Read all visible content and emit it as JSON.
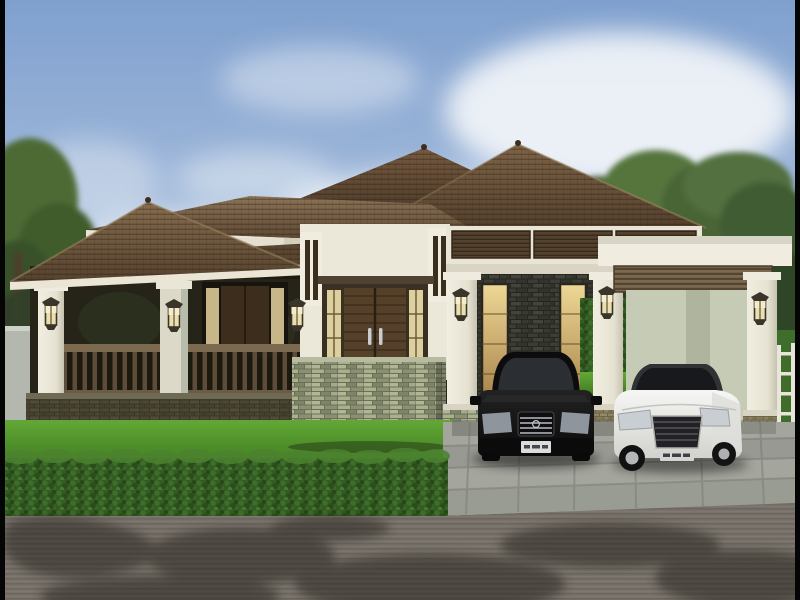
{
  "scene": {
    "type": "architectural-render",
    "description": "3D rendering of a single-story tropical bungalow: hip tile roofs, covered porch with wood railing, stacked-stone accent wall with double wood doors, lantern sconces, twin carports sheltering a black sedan and a white coupe, green hedge, paver driveway and shadowed asphalt road under a cloudy blue sky",
    "sky": {
      "top": "#7fa0ce",
      "bottom": "#bccfe6",
      "cloud": "#f2f5f9"
    },
    "vegetation": {
      "tree": "#4d6a34",
      "tree_dark": "#2e4424",
      "hedge": "#335c22",
      "hedge_light": "#4c8230",
      "grass": "#55962d",
      "grass_light": "#6cae3c"
    },
    "house": {
      "roof": "#6f5843",
      "roof_dark": "#4b3929",
      "fascia": "#eae5d5",
      "wall": "#e4dfcf",
      "entry_wall": "#ebe7d9",
      "trim_dark": "#4e4232",
      "door_wood": "#55402a",
      "door_frame": "#3a3022",
      "sidelight_glow": "#ddd0a0",
      "stone": "#9aa085",
      "dark_stone": "#30322b",
      "amber_window": "#d9b96c",
      "column": "#efecdf",
      "railing": "#7b6950",
      "baluster": "#5d4c38",
      "porch_base": "#474330",
      "porch_interior": "#262418",
      "louver": "#53422e",
      "slat_band": "#7a6850",
      "pale_wall": "#c6cbb6",
      "lamp_glass": "#ecdfae",
      "lamp_frame": "#3a352a",
      "base_brick": "#8d8263"
    },
    "ground": {
      "boundary_wall": "#b3b7ae",
      "driveway": "#a4a69e",
      "paver_joint": "#8d8f87",
      "curb": "#8e9088",
      "road": "#78726a",
      "shadow": "#2c2824"
    },
    "vehicles": {
      "black_sedan": {
        "body": "#111111",
        "glass": "#2b2e33",
        "chrome": "#b8bcc0",
        "plate": "#dcdcdc"
      },
      "white_coupe": {
        "body": "#ececec",
        "glass": "#17191c",
        "roof": "#303236",
        "grille": "#222226",
        "plate": "#d4d4d0"
      }
    },
    "frame_bar": "#050505",
    "objects": [
      "sky",
      "clouds",
      "trees",
      "boundary-wall",
      "hip-roofs",
      "porch",
      "columns",
      "wall-lanterns",
      "wood-railing",
      "double-wood-door",
      "stone-accent-wall",
      "carport-louvers",
      "black-sedan",
      "white-coupe",
      "flat-roof-carport",
      "white-fence",
      "lawn",
      "hedge",
      "paver-driveway",
      "asphalt-road"
    ]
  }
}
